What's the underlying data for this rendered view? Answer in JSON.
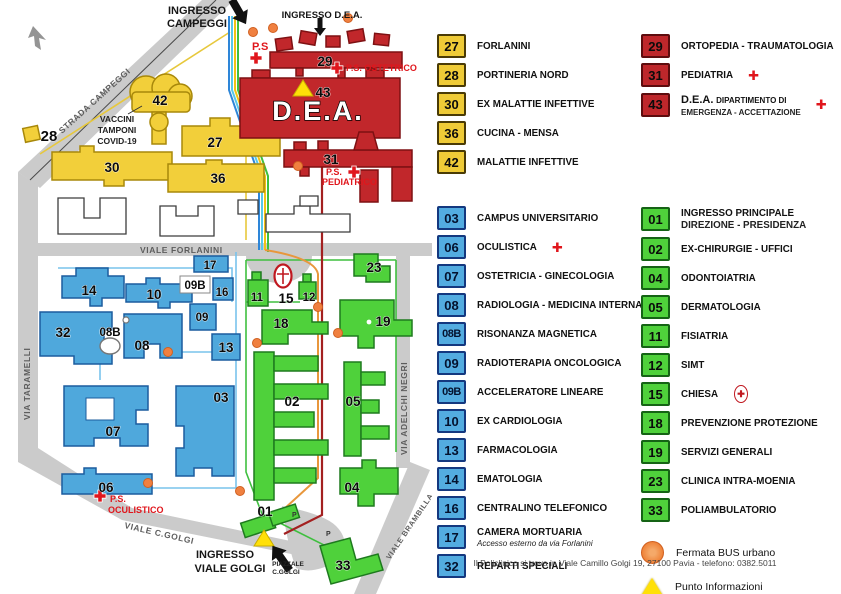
{
  "map": {
    "entrances": {
      "campeggi_line1": "INGRESSO",
      "campeggi_line2": "CAMPEGGI",
      "dea": "INGRESSO D.E.A.",
      "golgi_line1": "INGRESSO",
      "golgi_line2": "VIALE GOLGI"
    },
    "roads": {
      "strada_campeggi": "STRADA CAMPEGGI",
      "via_taramelli": "VIA TARAMELLI",
      "viale_forlanini": "VIALE FORLANINI",
      "via_adelchi_negri": "VIA ADELCHI NEGRI",
      "viale_c_golgi": "VIALE C.GOLGI",
      "viale_brambilla": "VIALE BRAMBILLA",
      "piazzale_line1": "PIAZZALE",
      "piazzale_line2": "C.GOLGI"
    },
    "notes": {
      "vaccini_line1": "VACCINI",
      "vaccini_line2": "TAMPONI",
      "vaccini_line3": "COVID-19"
    },
    "dea_label": "D.E.A.",
    "ps_labels": {
      "ps": "P.S",
      "ps_ostetrico": "P.S. OSTETRICO",
      "ps_pediatrico_line1": "P.S.",
      "ps_pediatrico_line2": "PEDIATRICO",
      "ps_oculistico_line1": "P.S.",
      "ps_oculistico_line2": "OCULISTICO"
    },
    "parking": "P",
    "building_numbers": {
      "b27": "27",
      "b28": "28",
      "b29": "29",
      "b30": "30",
      "b31": "31",
      "b36": "36",
      "b42": "42",
      "b43": "43",
      "b14": "14",
      "b10": "10",
      "b17": "17",
      "b09b": "09B",
      "b16": "16",
      "b09": "09",
      "b13": "13",
      "b08": "08",
      "b08b": "08B",
      "b32": "32",
      "b07": "07",
      "b06": "06",
      "b03": "03",
      "b11": "11",
      "b15": "15",
      "b12": "12",
      "b23": "23",
      "b18": "18",
      "b19": "19",
      "b02": "02",
      "b05": "05",
      "b04": "04",
      "b01": "01",
      "b33": "33"
    }
  },
  "legend": {
    "yellow": [
      {
        "num": "27",
        "label": "FORLANINI"
      },
      {
        "num": "28",
        "label": "PORTINERIA NORD"
      },
      {
        "num": "30",
        "label": "EX MALATTIE INFETTIVE"
      },
      {
        "num": "36",
        "label": "CUCINA - MENSA"
      },
      {
        "num": "42",
        "label": "MALATTIE INFETTIVE"
      }
    ],
    "red": [
      {
        "num": "29",
        "label": "ORTOPEDIA - TRAUMATOLOGIA"
      },
      {
        "num": "31",
        "label": "PEDIATRIA"
      },
      {
        "num": "43",
        "label_big": "D.E.A.",
        "label_small": "DIPARTIMENTO DI",
        "label_small2": "EMERGENZA - ACCETTAZIONE"
      }
    ],
    "blue": [
      {
        "num": "03",
        "label": "CAMPUS UNIVERSITARIO"
      },
      {
        "num": "06",
        "label": "OCULISTICA"
      },
      {
        "num": "07",
        "label": "OSTETRICIA - GINECOLOGIA"
      },
      {
        "num": "08",
        "label": "RADIOLOGIA - MEDICINA INTERNA"
      },
      {
        "num": "08B",
        "label": "RISONANZA MAGNETICA"
      },
      {
        "num": "09",
        "label": "RADIOTERAPIA ONCOLOGICA"
      },
      {
        "num": "09B",
        "label": "ACCELERATORE LINEARE"
      },
      {
        "num": "10",
        "label": "EX CARDIOLOGIA"
      },
      {
        "num": "13",
        "label": "FARMACOLOGIA"
      },
      {
        "num": "14",
        "label": "EMATOLOGIA"
      },
      {
        "num": "16",
        "label": "CENTRALINO TELEFONICO"
      },
      {
        "num": "17",
        "label": "CAMERA MORTUARIA",
        "sublabel": "Accesso esterno da via Forlanini"
      },
      {
        "num": "32",
        "label": "REPARTI SPECIALI"
      }
    ],
    "green": [
      {
        "num": "01",
        "label": "INGRESSO PRINCIPALE",
        "label2": "DIREZIONE - PRESIDENZA"
      },
      {
        "num": "02",
        "label": "EX-CHIRURGIE - UFFICI"
      },
      {
        "num": "04",
        "label": "ODONTOIATRIA"
      },
      {
        "num": "05",
        "label": "DERMATOLOGIA"
      },
      {
        "num": "11",
        "label": "FISIATRIA"
      },
      {
        "num": "12",
        "label": "SIMT"
      },
      {
        "num": "15",
        "label": "CHIESA"
      },
      {
        "num": "18",
        "label": "PREVENZIONE PROTEZIONE"
      },
      {
        "num": "19",
        "label": "SERVIZI GENERALI"
      },
      {
        "num": "23",
        "label": "CLINICA INTRA-MOENIA"
      },
      {
        "num": "33",
        "label": "POLIAMBULATORIO"
      }
    ],
    "symbols": {
      "bus": "Fermata BUS urbano",
      "info": "Punto Informazioni",
      "cross": "✚"
    },
    "footer": "Il Policlinico si trova in Viale Camillo Golgi 19, 27100 Pavia - telefono: 0382.5011"
  },
  "colors": {
    "accent_yellow": "#EFCB37",
    "accent_red": "#BE272B",
    "accent_blue": "#53ACE0",
    "accent_green": "#4FD13B",
    "bus_orange": "#F08040",
    "info_yellow": "#FFE008",
    "ps_red": "#E0161C"
  }
}
